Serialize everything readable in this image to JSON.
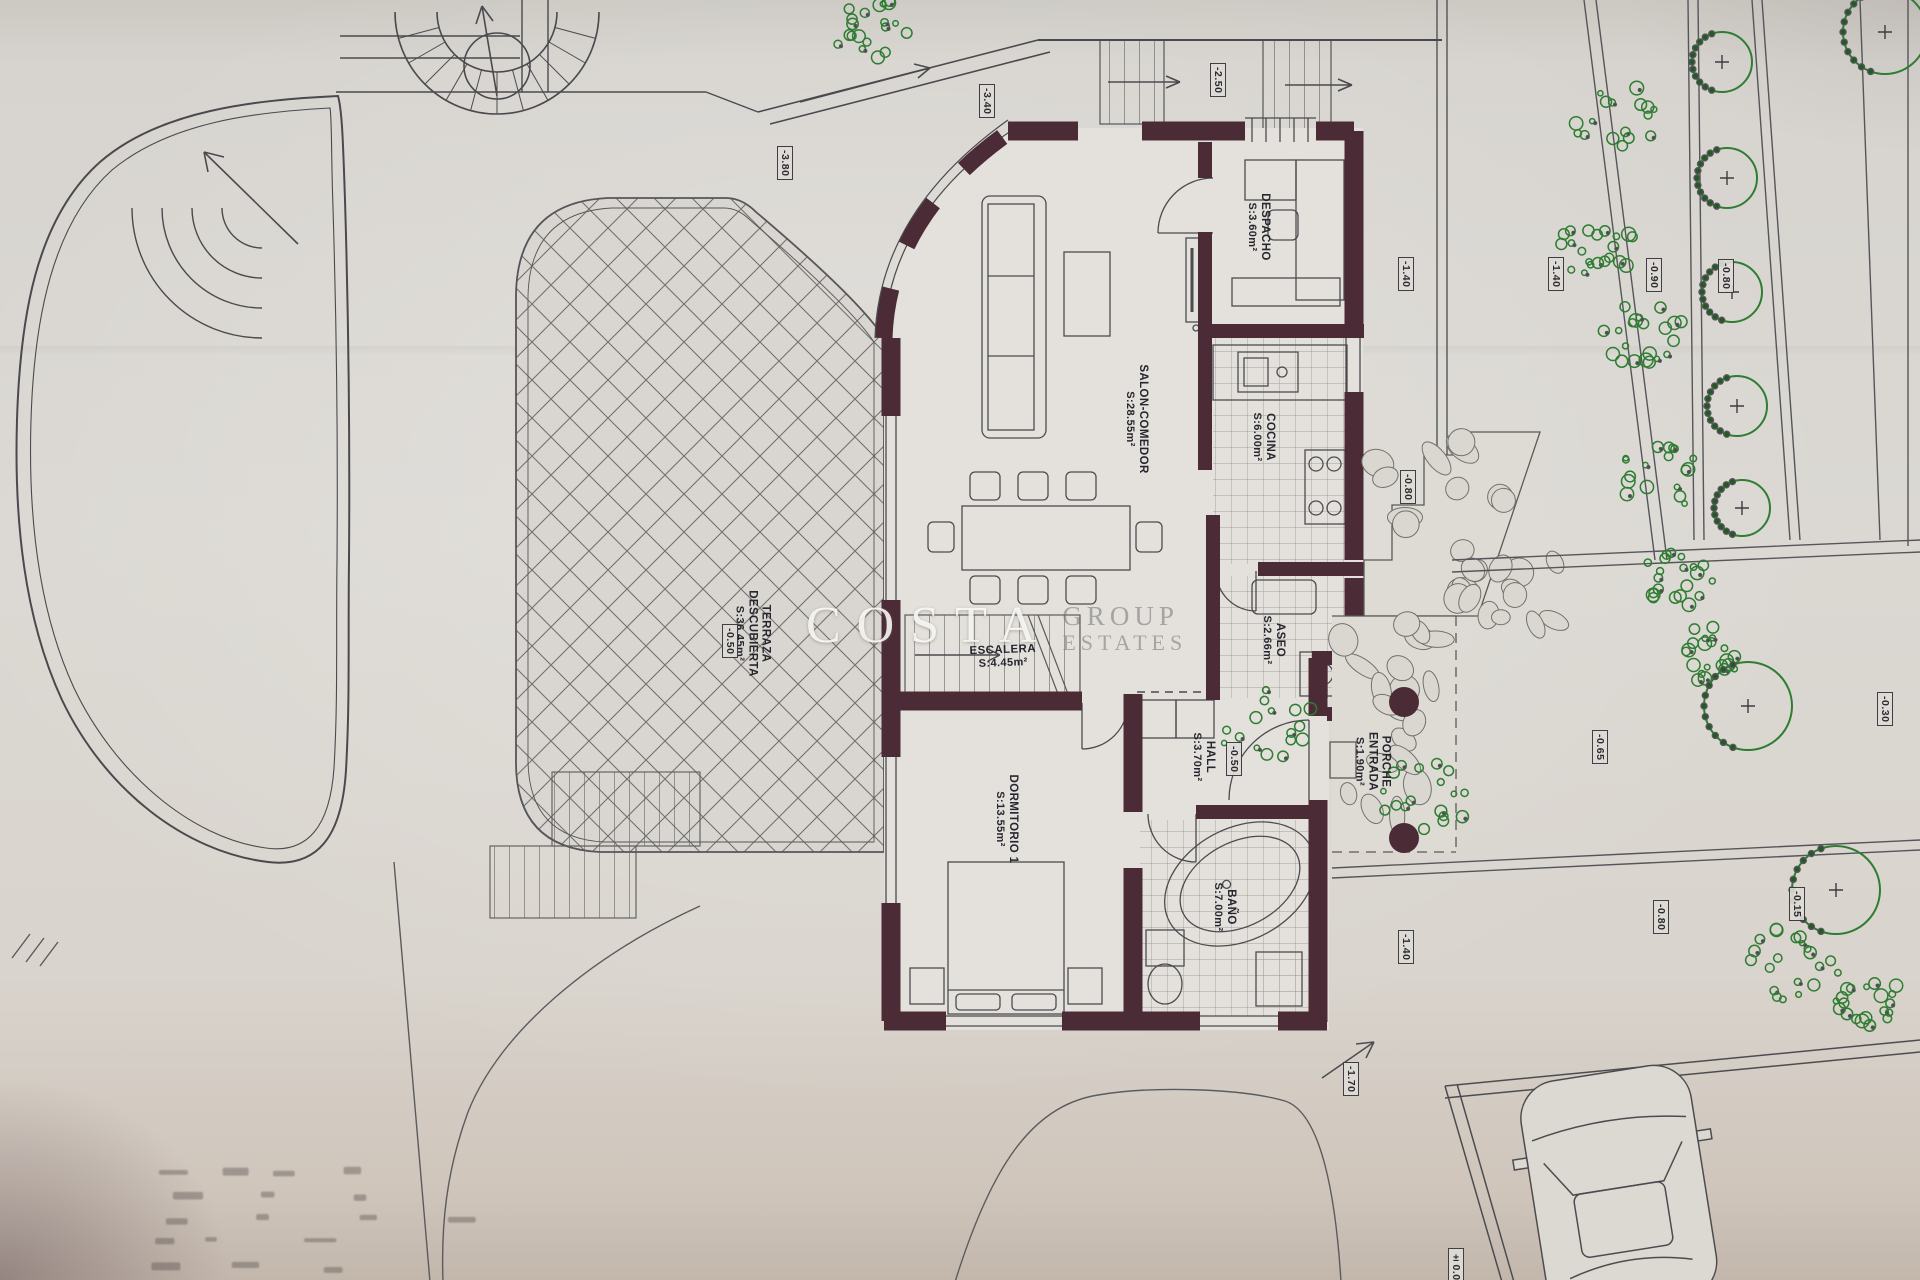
{
  "plan": {
    "watermark": {
      "word1": "COSTA",
      "word2": "GROUP",
      "word3": "ESTATES"
    },
    "rooms": [
      {
        "name": "SALON-COMEDOR",
        "area": "S:28.55m²"
      },
      {
        "name": "DESPACHO",
        "area": "S:3.60m²"
      },
      {
        "name": "COCINA",
        "area": "S:6.00m²"
      },
      {
        "name": "ESCALERA",
        "area": "S:4.45m²"
      },
      {
        "name": "ASEO",
        "area": "S:2.66m²"
      },
      {
        "name": "HALL",
        "area": "S:3.70m²"
      },
      {
        "name": "PORCHE",
        "name2": "ENTRADA",
        "area": "S:1.90m²"
      },
      {
        "name": "DORMITORIO 1",
        "area": "S:13.55m²"
      },
      {
        "name": "BAÑO",
        "area": "S:7.00m²"
      },
      {
        "name": "TERRAZA",
        "name2": "DESCUBIERTA",
        "area": "S:36.45m²"
      }
    ],
    "elevations": [
      "-3.80",
      "-3.40",
      "-2.50",
      "-1.40",
      "-1.40",
      "-0.90",
      "-0.80",
      "-0.80",
      "-0.30",
      "-0.65",
      "-0.50",
      "-0.50",
      "-1.40",
      "-0.80",
      "-0.15",
      "-1.70",
      "±0.00"
    ]
  }
}
